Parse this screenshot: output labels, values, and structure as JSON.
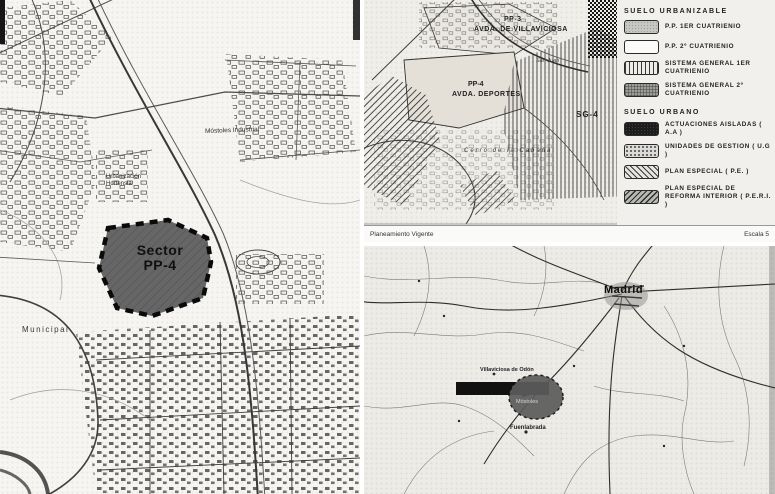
{
  "document": {
    "type_label": "Planeamiento urbanístico escaneado"
  },
  "left_map": {
    "sector": {
      "line1": "Sector",
      "line2": "PP-4"
    },
    "labels": {
      "mostoles_industrial": "Móstoles Industrial",
      "urbanizacion": "Urbanización Hortensia",
      "municipal": "Municipal"
    }
  },
  "planning_map": {
    "labels": {
      "pp3": "PP-3",
      "pp3_sub": "AVDA. DE VILLAVICIOSA",
      "pp4": "PP-4",
      "pp4_sub": "AVDA. DEPORTES",
      "sg4": "SG-4",
      "cerro": "Cerro de la Cabaña",
      "san_juan": "San Juan"
    },
    "caption_left": "Planeamiento Vigente",
    "caption_right": "Escala 5"
  },
  "legend": {
    "urbanizable": {
      "title": "SUELO URBANIZABLE",
      "items": [
        {
          "label": "P.P. 1er CUATRIENIO",
          "swatch": "shaded"
        },
        {
          "label": "P.P. 2º CUATRIENIO",
          "swatch": "white"
        },
        {
          "label": "SISTEMA GENERAL 1er CUATRIENIO",
          "swatch": "vlines"
        },
        {
          "label": "SISTEMA GENERAL 2º CUATRIENIO",
          "swatch": "dense"
        }
      ]
    },
    "urbano": {
      "title": "SUELO URBANO",
      "items": [
        {
          "label": "ACTUACIONES AISLADAS ( A.A )",
          "swatch": "solid"
        },
        {
          "label": "UNIDADES DE GESTION ( U.G )",
          "swatch": "dots"
        },
        {
          "label": "PLAN ESPECIAL ( P.E. )",
          "swatch": "hatch"
        },
        {
          "label": "PLAN ESPECIAL DE REFORMA INTERIOR ( P.E.R.I. )",
          "swatch": "hatch2"
        }
      ]
    }
  },
  "region_map": {
    "labels": {
      "madrid": "Madrid",
      "villaviciosa": "Villaviciosa de Odón",
      "mostoles": "Móstoles",
      "fuenlabrada": "Fuenlabrada"
    }
  },
  "colors": {
    "sector_fill": "#666666",
    "marker_fill": "#5c5c5c",
    "marker_bar": "#111111",
    "paper": "#f2f0ec",
    "ink": "#3a3a3a"
  }
}
